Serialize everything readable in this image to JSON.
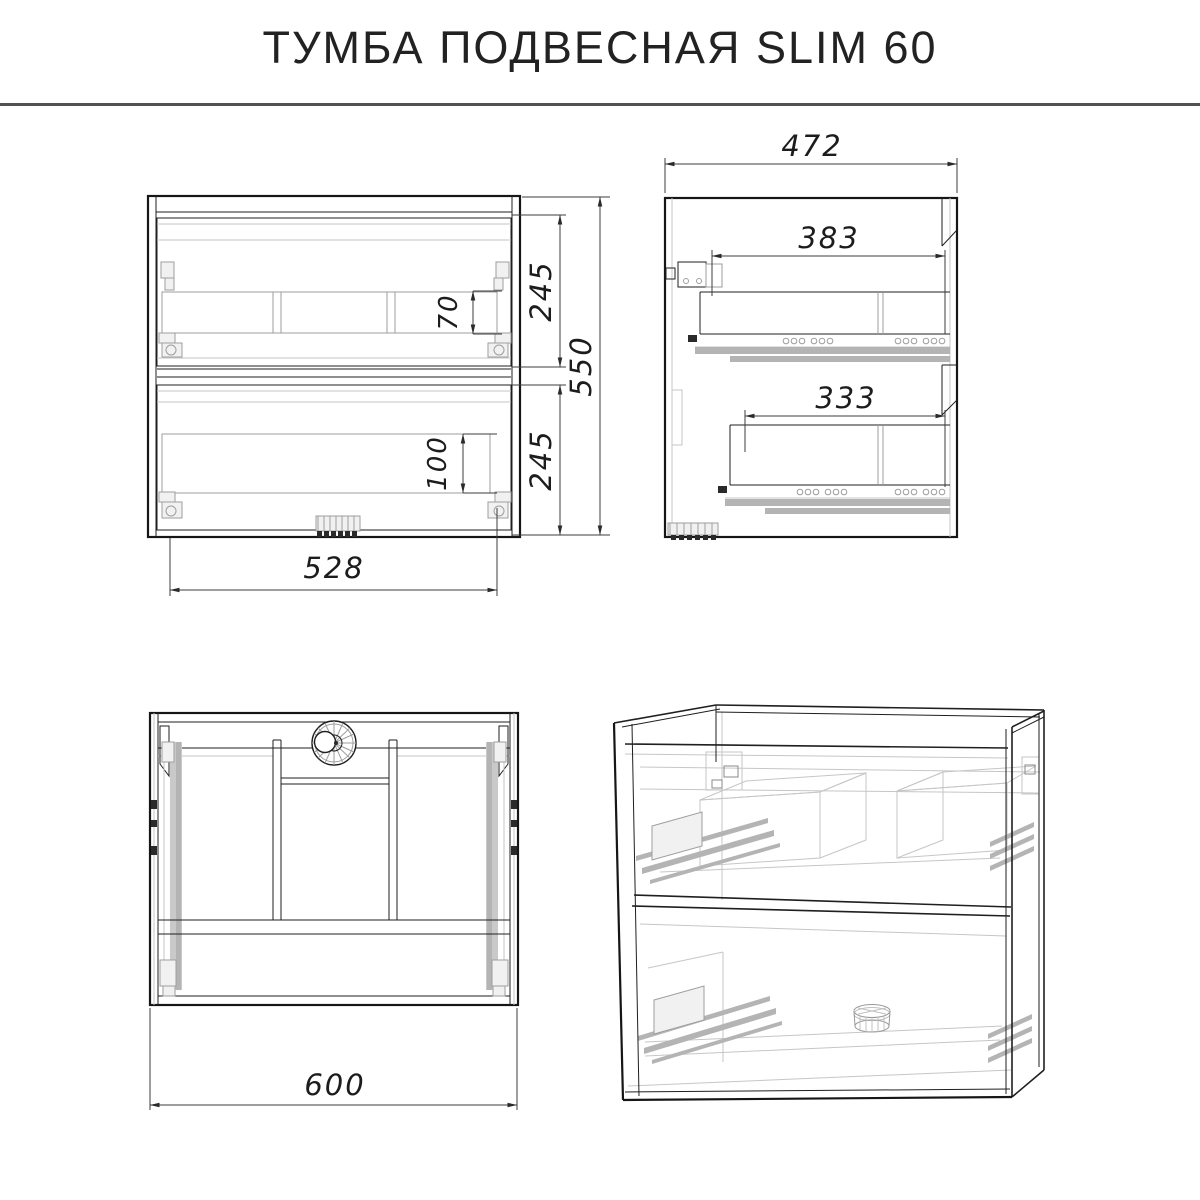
{
  "title": "ТУМБА ПОДВЕСНАЯ SLIM 60",
  "dims": {
    "front": {
      "drawer_top_height": "245",
      "drawer_bottom_height": "245",
      "total_height": "550",
      "inner_width": "528",
      "top_inset": "70",
      "bottom_inset": "100"
    },
    "side": {
      "depth": "472",
      "top_slide_length": "383",
      "bottom_slide_length": "333"
    },
    "top": {
      "total_width": "600"
    }
  }
}
